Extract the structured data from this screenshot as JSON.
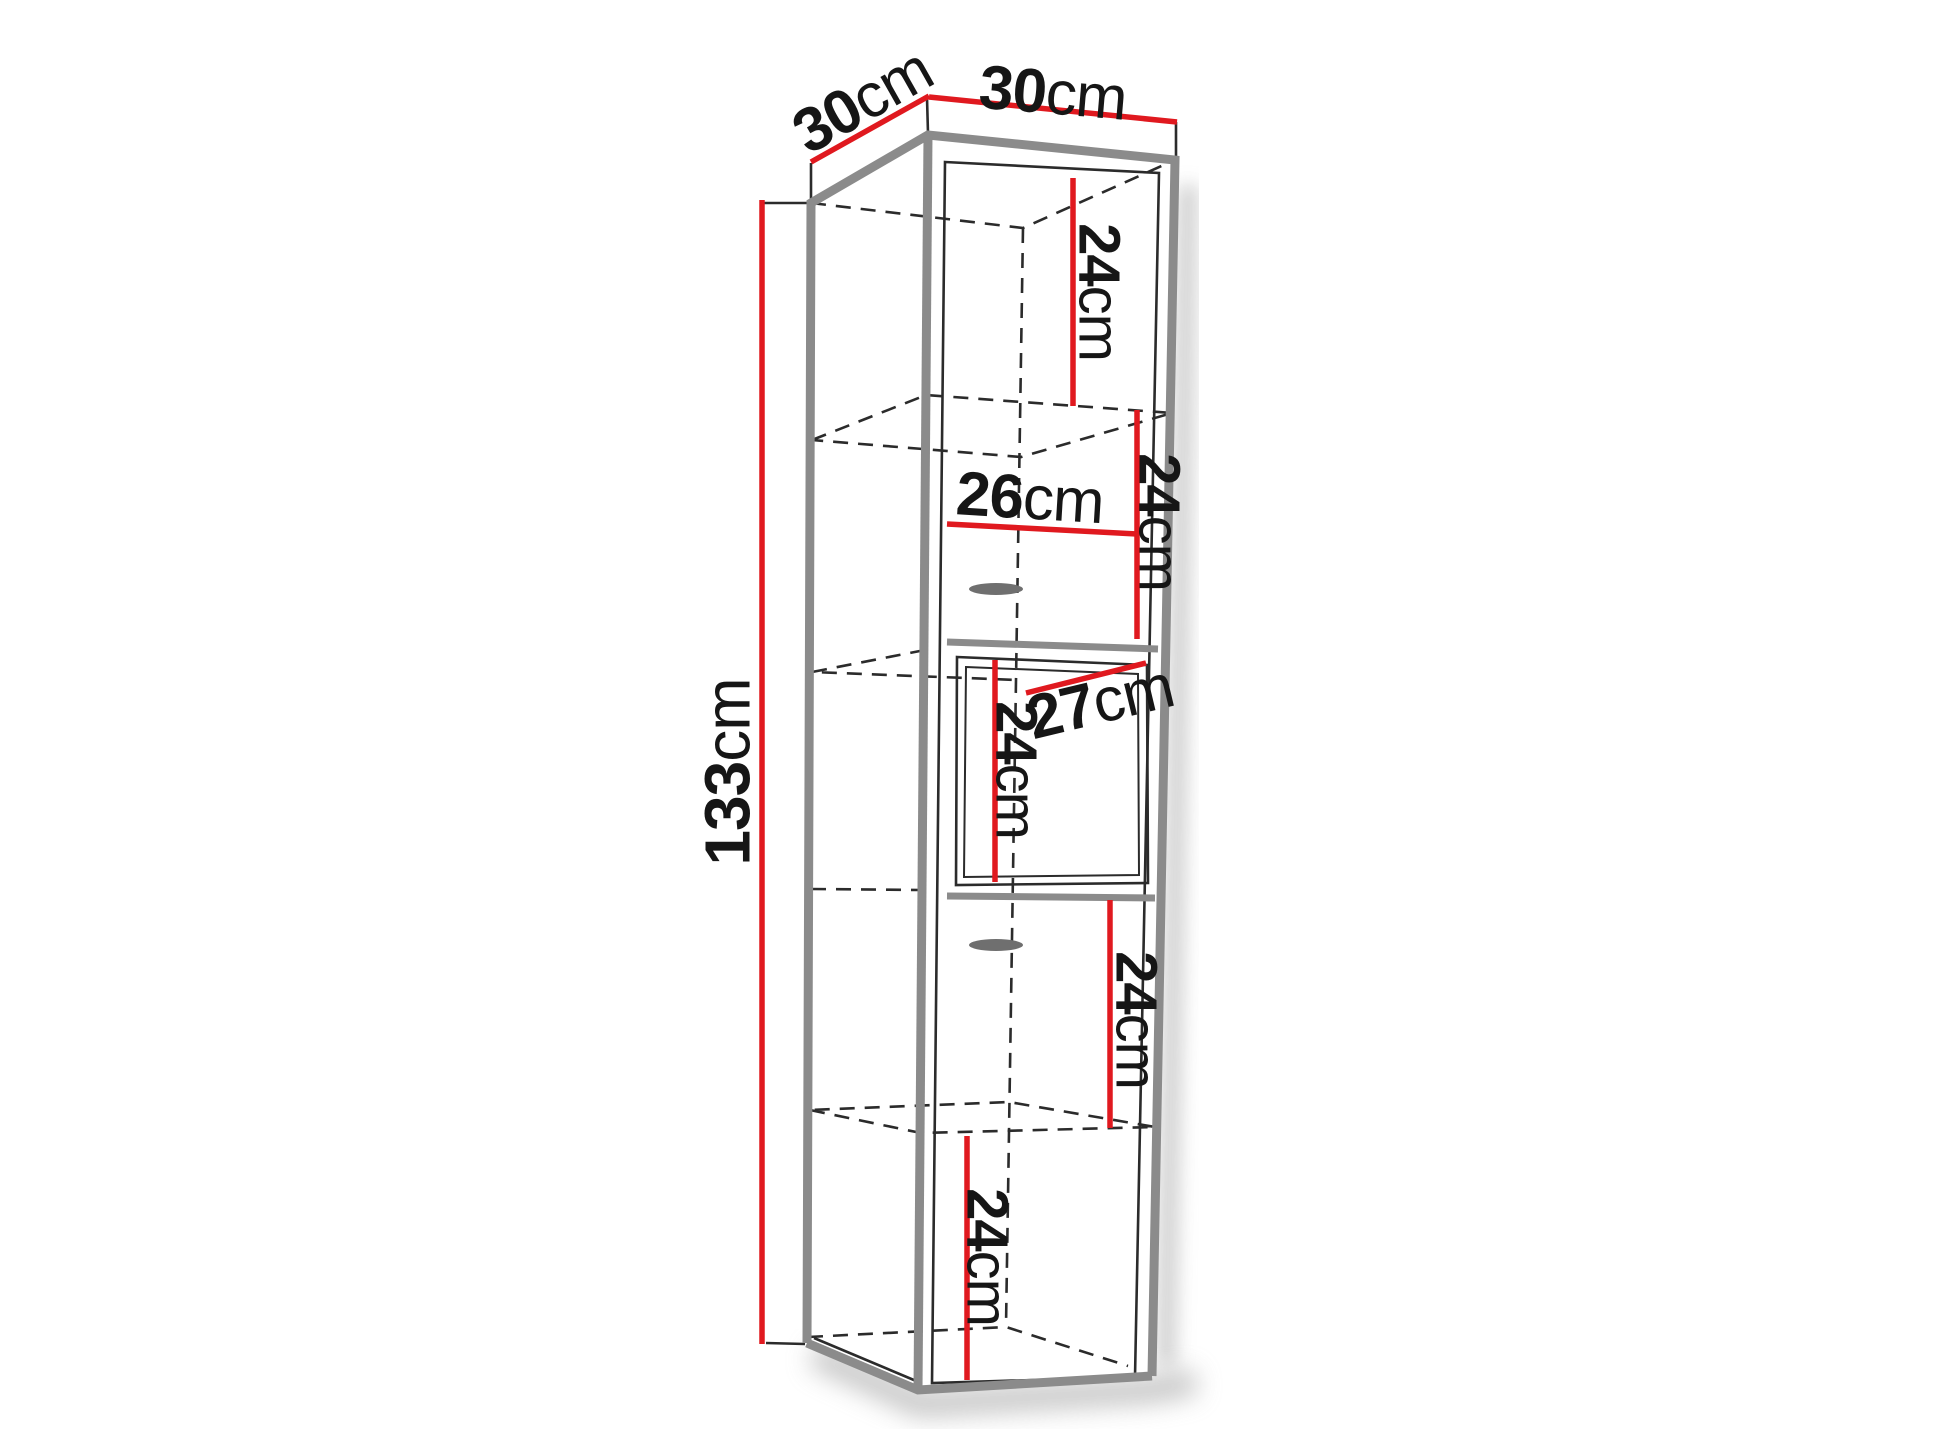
{
  "diagram": {
    "type": "furniture-dimension-drawing",
    "subject": "tall wall-hung corner cabinet with five compartments and middle door",
    "dimensions": {
      "depth_top": {
        "value": "30",
        "unit": "cm"
      },
      "width_top": {
        "value": "30",
        "unit": "cm"
      },
      "height_overall": {
        "value": "133",
        "unit": "cm"
      },
      "compartment_1_height": {
        "value": "24",
        "unit": "cm"
      },
      "interior_width": {
        "value": "26",
        "unit": "cm"
      },
      "compartment_2_height": {
        "value": "24",
        "unit": "cm"
      },
      "door_width": {
        "value": "27",
        "unit": "cm"
      },
      "door_height": {
        "value": "24",
        "unit": "cm"
      },
      "compartment_4_height": {
        "value": "24",
        "unit": "cm"
      },
      "compartment_5_height": {
        "value": "24",
        "unit": "cm"
      }
    },
    "colors": {
      "dimension_line": "#e0191f",
      "edge": "#8b8b8b",
      "line": "#2b2b2b",
      "text": "#161616",
      "background": "#ffffff"
    }
  }
}
